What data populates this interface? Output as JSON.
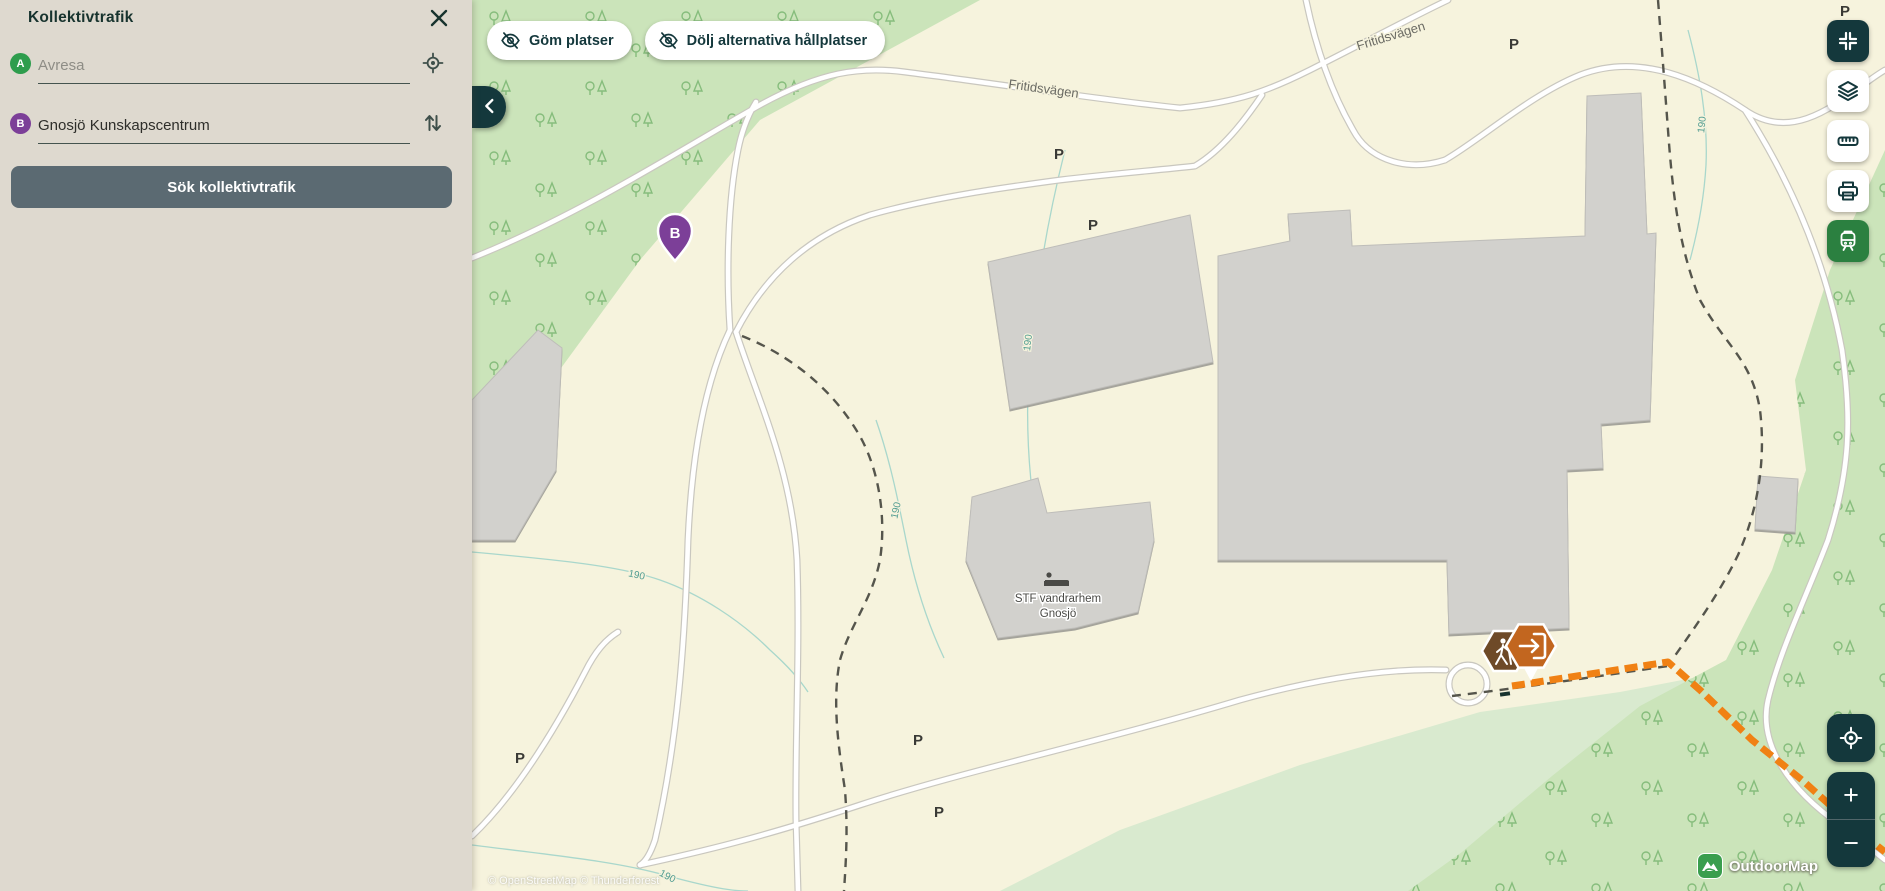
{
  "sidebar": {
    "title": "Kollektivtrafik",
    "fields": [
      {
        "marker": "A",
        "placeholder": "Avresa",
        "value": ""
      },
      {
        "marker": "B",
        "placeholder": "",
        "value": "Gnosjö Kunskapscentrum"
      }
    ],
    "search_button": "Sök kollektivtrafik"
  },
  "map": {
    "buttons": {
      "hide_places": "Göm platser",
      "hide_alt_stops": "Dölj alternativa hållplatser"
    },
    "labels": {
      "road": "Fritidsvägen",
      "contour": "190",
      "parking": "P",
      "place_line1": "STF vandrarhem",
      "place_line2": "Gnosjö",
      "marker_b": "B"
    },
    "attribution": "© OpenStreetMap © Thunderforest",
    "logo": "OutdoorMap"
  },
  "controls": {
    "zoom_in": "+",
    "zoom_out": "−"
  },
  "colors": {
    "accent_dark": "#14383C",
    "slate_button": "#5B6A72",
    "transit_green": "#2B8040",
    "route_orange": "#F08114",
    "marker_purple": "#7C3F98",
    "marker_green": "#2E9D4D",
    "forest": "#CBE4BA",
    "forest_light": "#D9EACF",
    "map_bg": "#F6F3DD",
    "sidebar_bg": "#DED9CF"
  }
}
